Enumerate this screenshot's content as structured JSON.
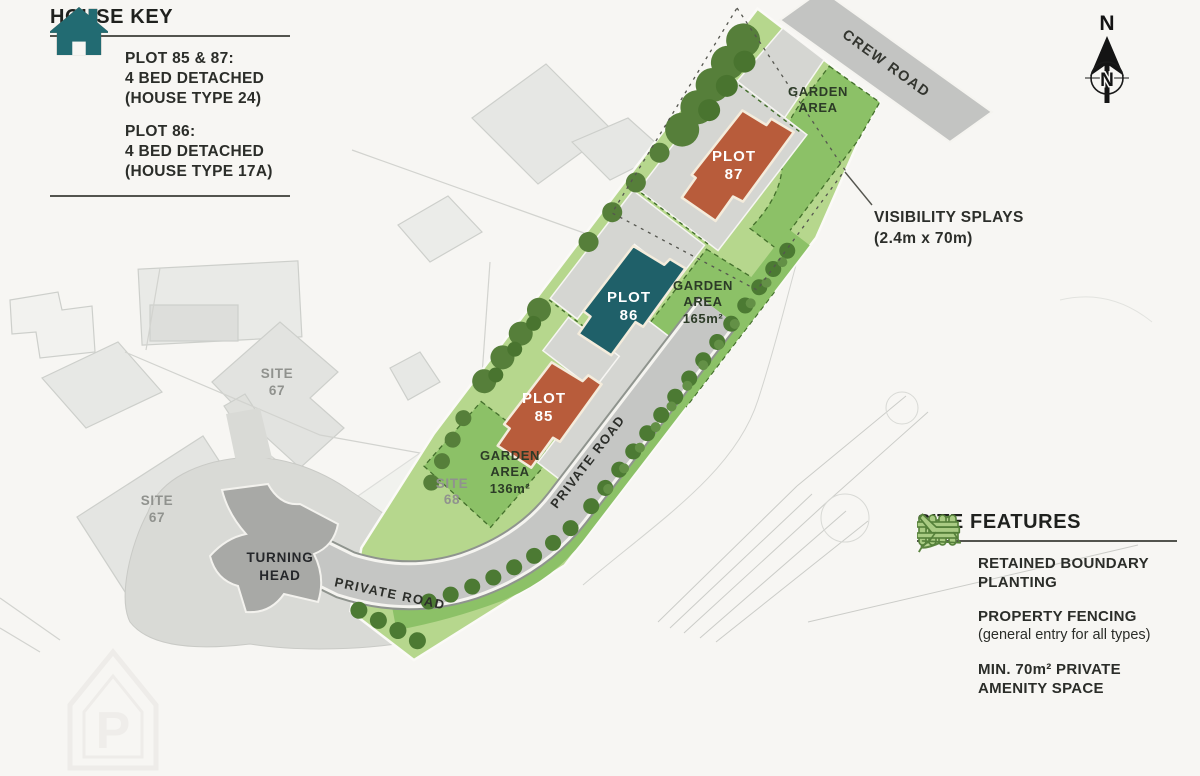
{
  "house_key": {
    "title": "HOUSE KEY",
    "items": [
      {
        "icon": "house-icon",
        "color": "#bc5f3c",
        "line1": "PLOT 85 & 87:",
        "line2": "4 BED DETACHED",
        "line3": "(HOUSE TYPE 24)"
      },
      {
        "icon": "house-icon",
        "color": "#226b72",
        "line1": "PLOT 86:",
        "line2": "4 BED DETACHED",
        "line3": "(HOUSE TYPE 17A)"
      }
    ]
  },
  "site_features": {
    "title": "SITE FEATURES",
    "items": [
      {
        "icon": "leaf-icon",
        "line1": "RETAINED BOUNDARY",
        "line2": "PLANTING"
      },
      {
        "icon": "fence-icon",
        "line1": "PROPERTY FENCING",
        "line2": "(general entry for all types)"
      },
      {
        "icon": "lounger-icon",
        "line1": "MIN. 70m² PRIVATE",
        "line2": "AMENITY SPACE"
      }
    ]
  },
  "map": {
    "roads": {
      "crew": "CREW ROAD",
      "private_upper": "PRIVATE ROAD",
      "private_lower": "PRIVATE ROAD"
    },
    "turning_head": {
      "line1": "TURNING",
      "line2": "HEAD"
    },
    "visibility": {
      "line1": "VISIBILITY SPLAYS",
      "line2": "(2.4m x 70m)"
    },
    "plots": {
      "p87": {
        "line1": "PLOT",
        "line2": "87"
      },
      "p86": {
        "line1": "PLOT",
        "line2": "86"
      },
      "p85": {
        "line1": "PLOT",
        "line2": "85"
      }
    },
    "gardens": {
      "g87": {
        "line1": "GARDEN",
        "line2": "AREA",
        "line3": ""
      },
      "g86": {
        "line1": "GARDEN",
        "line2": "AREA",
        "line3": "165m²"
      },
      "g85": {
        "line1": "GARDEN",
        "line2": "AREA",
        "line3": "136m²"
      }
    },
    "sites": {
      "s67a": {
        "line1": "SITE",
        "line2": "67"
      },
      "s67b": {
        "line1": "SITE",
        "line2": "67"
      },
      "s68": {
        "line1": "SITE",
        "line2": "68"
      }
    },
    "compass": {
      "label": "N",
      "inner": "N"
    },
    "watermark": "P"
  },
  "colors": {
    "plot85_87_house": "#b85c3b",
    "plot86_house": "#1f6069",
    "garden_green": "#8cc167",
    "base_green": "#b6d78d",
    "road_gray": "#c5c6c4",
    "turning_head_gray": "#a8a9a6"
  }
}
